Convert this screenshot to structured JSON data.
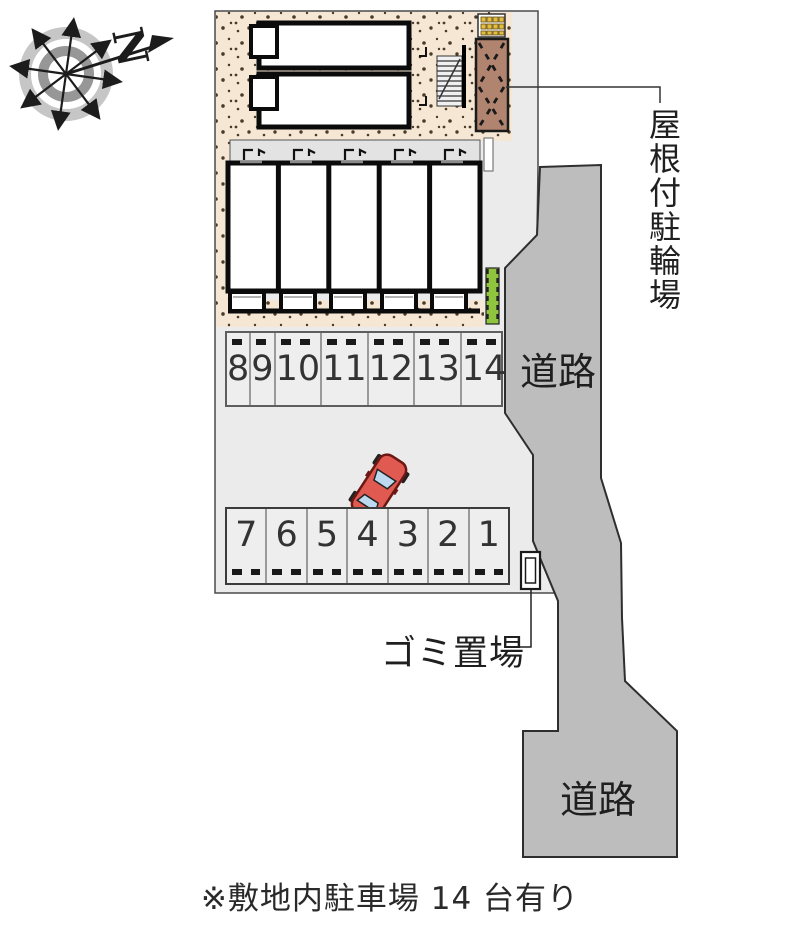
{
  "compass": {
    "north_label": "N"
  },
  "labels": {
    "bicycle_parking": "屋根付駐輪場",
    "road_upper": "道路",
    "road_lower": "道路",
    "garbage": "ゴミ置場",
    "note": "※敷地内駐車場 14 台有り"
  },
  "parking": {
    "row_top": {
      "stalls": [
        "8",
        "9",
        "10",
        "11",
        "12",
        "13",
        "14"
      ]
    },
    "row_bottom": {
      "stalls": [
        "7",
        "6",
        "5",
        "4",
        "3",
        "2",
        "1"
      ]
    }
  },
  "colors": {
    "site_fill": "#ebebeb",
    "road_fill": "#bdbdbd",
    "beige_fill": "#f5e7d3",
    "shed_fill": "#b1846f",
    "hedge_fill": "#8fc43e",
    "car_body": "#e05a52",
    "car_window": "#bcd9f0",
    "meter_yellow": "#e3bd3f"
  }
}
